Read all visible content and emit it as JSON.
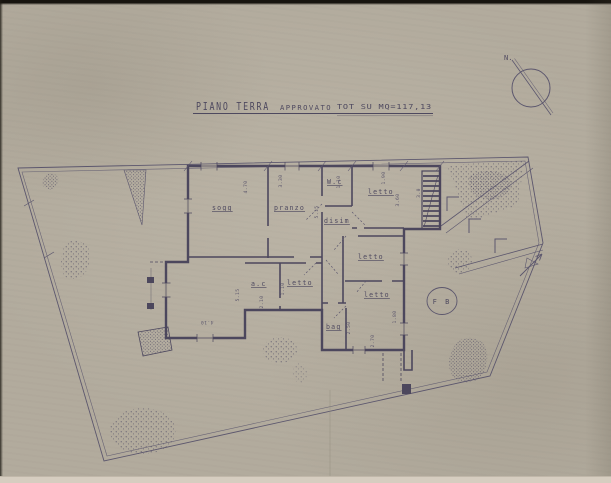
{
  "document": {
    "title": "PIANO TERRA",
    "approval": "APPROVATO",
    "area_note": "TOT SU MQ=117,13"
  },
  "compass": {
    "north": "N."
  },
  "rooms": {
    "soggiorno": "sogg",
    "pranzo": "pranzo",
    "wc": "W.c",
    "letto_nord": "letto",
    "disimpegno": "disim",
    "letto_est": "letto",
    "letto_centro": "letto",
    "angolo_cottura": "a.c",
    "letto_sud": "letto",
    "bagno": "bag"
  },
  "marker": {
    "fb": "F B"
  },
  "dimensions": {
    "d0": "4.70",
    "d1": "3.30",
    "d2": "5.15",
    "d3": "1.10",
    "d4": "1.90",
    "d5": "3.60",
    "d6": "3.0",
    "d7": "4.10",
    "d8": "5.15",
    "d9": "2.10",
    "d10": "2.50",
    "d11": "1.80",
    "d12": "2.70",
    "d13": "1.10"
  },
  "colors": {
    "paper": "#b2ab9d",
    "ink": "#4a4560",
    "ink_soft": "#5e5975"
  }
}
